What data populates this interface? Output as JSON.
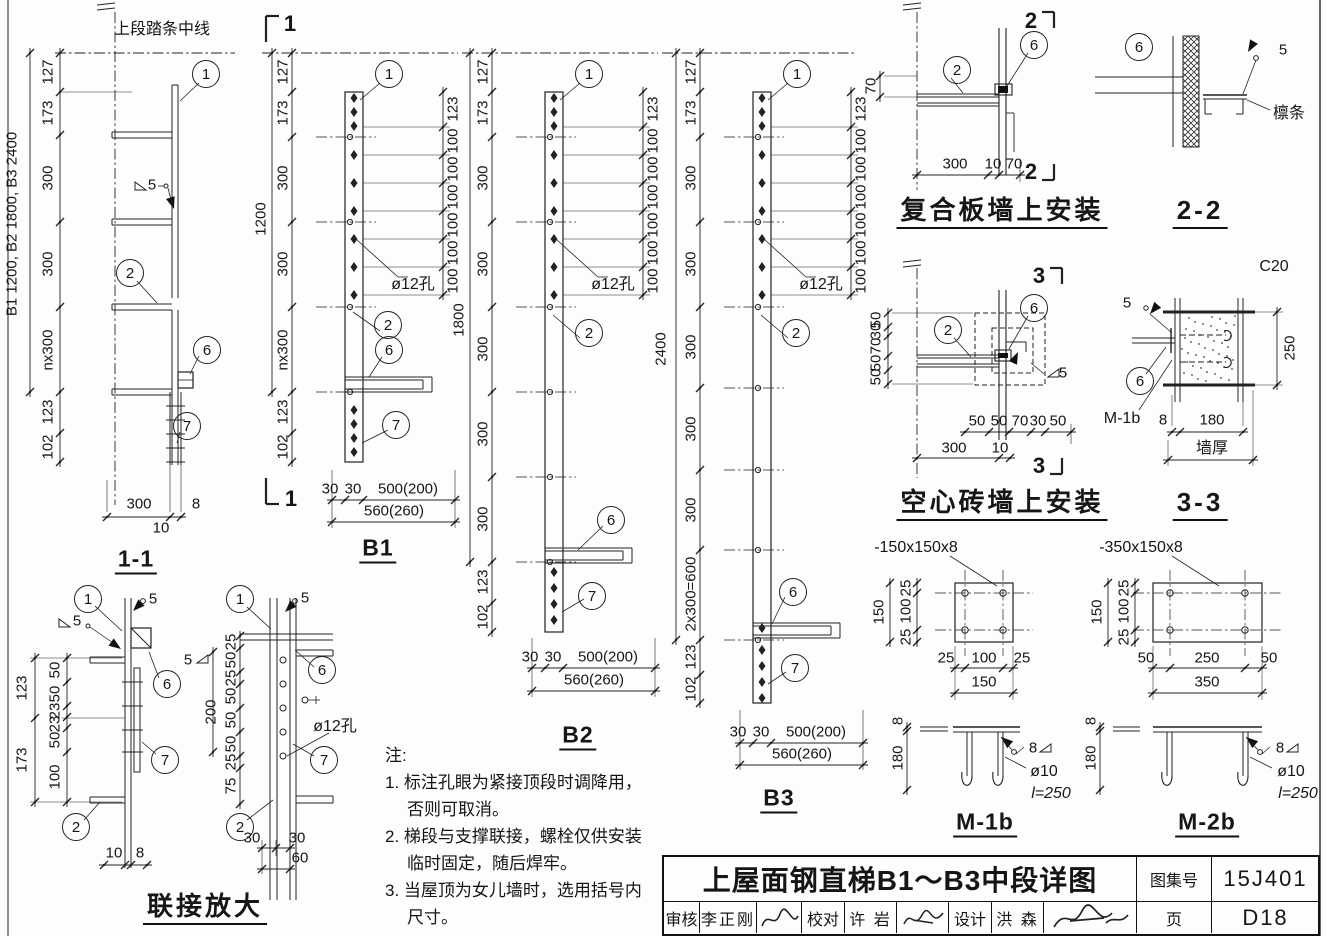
{
  "titleblock": {
    "title": "上屋面钢直梯B1～B3中段详图",
    "atlas_label": "图集号",
    "atlas_no": "15J401",
    "page_label": "页",
    "page_no": "D18",
    "audit_label": "审核",
    "audit_name": "李正刚",
    "proof_label": "校对",
    "proof_name": "许 岩",
    "design_label": "设计",
    "design_name": "洪 森"
  },
  "notes": {
    "heading": "注:",
    "items": [
      {
        "first": "1. 标注孔眼为紧接顶段时调降用，",
        "cont": "否则可取消。"
      },
      {
        "first": "2. 梯段与支撑联接，螺栓仅供安装",
        "cont": "临时固定，随后焊牢。"
      },
      {
        "first": "3. 当屋顶为女儿墙时，选用括号内",
        "cont": "尺寸。"
      }
    ]
  },
  "labels": [
    {
      "t": "上段踏条中线",
      "x": 162,
      "y": 30,
      "c": "cn"
    },
    {
      "t": "B1 1200, B2 1800, B3 2400",
      "x": 12,
      "y": 224,
      "v": 1
    },
    {
      "t": "127",
      "x": 48,
      "y": 72,
      "v": 1
    },
    {
      "t": "173",
      "x": 48,
      "y": 113,
      "v": 1
    },
    {
      "t": "300",
      "x": 48,
      "y": 178,
      "v": 1
    },
    {
      "t": "300",
      "x": 48,
      "y": 264,
      "v": 1
    },
    {
      "t": "nx300",
      "x": 48,
      "y": 350,
      "v": 1
    },
    {
      "t": "123",
      "x": 48,
      "y": 412,
      "v": 1
    },
    {
      "t": "102",
      "x": 48,
      "y": 447,
      "v": 1
    },
    {
      "t": "1",
      "x": 206,
      "y": 74,
      "c": "callout"
    },
    {
      "t": "5",
      "x": 152,
      "y": 185
    },
    {
      "t": "2",
      "x": 130,
      "y": 273,
      "c": "callout"
    },
    {
      "t": "6",
      "x": 207,
      "y": 350,
      "c": "callout"
    },
    {
      "t": "7",
      "x": 187,
      "y": 426,
      "c": "callout"
    },
    {
      "t": "300",
      "x": 139,
      "y": 504
    },
    {
      "t": "8",
      "x": 196,
      "y": 504
    },
    {
      "t": "10",
      "x": 161,
      "y": 528
    },
    {
      "t": "1-1",
      "x": 136,
      "y": 561,
      "c": "title",
      "n": "title-section-1-1"
    },
    {
      "t": "1",
      "x": 88,
      "y": 599,
      "c": "callout"
    },
    {
      "t": "5",
      "x": 153,
      "y": 599
    },
    {
      "t": "5",
      "x": 77,
      "y": 621
    },
    {
      "t": "5",
      "x": 188,
      "y": 660
    },
    {
      "t": "6",
      "x": 167,
      "y": 684,
      "c": "callout"
    },
    {
      "t": "123",
      "x": 22,
      "y": 688,
      "v": 1
    },
    {
      "t": "173",
      "x": 22,
      "y": 760,
      "v": 1
    },
    {
      "t": "50",
      "x": 55,
      "y": 670,
      "v": 1
    },
    {
      "t": "50",
      "x": 55,
      "y": 694,
      "v": 1
    },
    {
      "t": "23",
      "x": 55,
      "y": 711,
      "v": 1
    },
    {
      "t": "23",
      "x": 55,
      "y": 724,
      "v": 1
    },
    {
      "t": "50",
      "x": 55,
      "y": 740,
      "v": 1
    },
    {
      "t": "100",
      "x": 55,
      "y": 777,
      "v": 1
    },
    {
      "t": "7",
      "x": 165,
      "y": 760,
      "c": "callout"
    },
    {
      "t": "2",
      "x": 76,
      "y": 827,
      "c": "callout"
    },
    {
      "t": "10",
      "x": 114,
      "y": 853
    },
    {
      "t": "8",
      "x": 140,
      "y": 853
    },
    {
      "t": "1",
      "x": 240,
      "y": 599,
      "c": "callout"
    },
    {
      "t": "5",
      "x": 305,
      "y": 598
    },
    {
      "t": "200",
      "x": 211,
      "y": 712,
      "v": 1
    },
    {
      "t": "25",
      "x": 231,
      "y": 642,
      "v": 1
    },
    {
      "t": "50",
      "x": 231,
      "y": 660,
      "v": 1
    },
    {
      "t": "25",
      "x": 231,
      "y": 678,
      "v": 1
    },
    {
      "t": "50",
      "x": 231,
      "y": 696,
      "v": 1
    },
    {
      "t": "50",
      "x": 231,
      "y": 720,
      "v": 1
    },
    {
      "t": "50",
      "x": 231,
      "y": 744,
      "v": 1
    },
    {
      "t": "25",
      "x": 231,
      "y": 762,
      "v": 1
    },
    {
      "t": "75",
      "x": 231,
      "y": 786,
      "v": 1
    },
    {
      "t": "6",
      "x": 322,
      "y": 670,
      "c": "callout"
    },
    {
      "t": "ø12孔",
      "x": 335,
      "y": 727,
      "c": "cn"
    },
    {
      "t": "7",
      "x": 324,
      "y": 760,
      "c": "callout"
    },
    {
      "t": "2",
      "x": 240,
      "y": 827,
      "c": "callout"
    },
    {
      "t": "30",
      "x": 252,
      "y": 838
    },
    {
      "t": "30",
      "x": 297,
      "y": 838
    },
    {
      "t": "60",
      "x": 300,
      "y": 858
    },
    {
      "t": "联接放大",
      "x": 205,
      "y": 909,
      "c": "bigtitle",
      "n": "heading-lianjie-fangda"
    },
    {
      "t": "1",
      "x": 290,
      "y": 24,
      "c": "secnum"
    },
    {
      "t": "1",
      "x": 291,
      "y": 499,
      "c": "secnum"
    },
    {
      "t": "1200",
      "x": 261,
      "y": 219,
      "v": 1
    },
    {
      "t": "127",
      "x": 283,
      "y": 72,
      "v": 1
    },
    {
      "t": "173",
      "x": 283,
      "y": 113,
      "v": 1
    },
    {
      "t": "300",
      "x": 283,
      "y": 178,
      "v": 1
    },
    {
      "t": "300",
      "x": 283,
      "y": 264,
      "v": 1
    },
    {
      "t": "nx300",
      "x": 283,
      "y": 350,
      "v": 1
    },
    {
      "t": "123",
      "x": 283,
      "y": 412,
      "v": 1
    },
    {
      "t": "102",
      "x": 283,
      "y": 447,
      "v": 1
    },
    {
      "t": "1",
      "x": 389,
      "y": 74,
      "c": "callout"
    },
    {
      "t": "123",
      "x": 453,
      "y": 109,
      "v": 1
    },
    {
      "t": "100",
      "x": 453,
      "y": 141,
      "v": 1
    },
    {
      "t": "100",
      "x": 453,
      "y": 169,
      "v": 1
    },
    {
      "t": "100",
      "x": 453,
      "y": 197,
      "v": 1
    },
    {
      "t": "100",
      "x": 453,
      "y": 225,
      "v": 1
    },
    {
      "t": "100",
      "x": 453,
      "y": 253,
      "v": 1
    },
    {
      "t": "100",
      "x": 453,
      "y": 281,
      "v": 1
    },
    {
      "t": "ø12孔",
      "x": 413,
      "y": 285,
      "c": "cn"
    },
    {
      "t": "2",
      "x": 388,
      "y": 325,
      "c": "callout"
    },
    {
      "t": "6",
      "x": 389,
      "y": 350,
      "c": "callout"
    },
    {
      "t": "7",
      "x": 396,
      "y": 425,
      "c": "callout"
    },
    {
      "t": "30",
      "x": 330,
      "y": 489
    },
    {
      "t": "30",
      "x": 353,
      "y": 489
    },
    {
      "t": "500(200)",
      "x": 408,
      "y": 489
    },
    {
      "t": "560(260)",
      "x": 394,
      "y": 511
    },
    {
      "t": "B1",
      "x": 378,
      "y": 550,
      "c": "title",
      "n": "title-b1"
    },
    {
      "t": "1800",
      "x": 459,
      "y": 320,
      "v": 1
    },
    {
      "t": "127",
      "x": 483,
      "y": 72,
      "v": 1
    },
    {
      "t": "173",
      "x": 483,
      "y": 113,
      "v": 1
    },
    {
      "t": "300",
      "x": 483,
      "y": 178,
      "v": 1
    },
    {
      "t": "300",
      "x": 483,
      "y": 264,
      "v": 1
    },
    {
      "t": "300",
      "x": 483,
      "y": 349,
      "v": 1
    },
    {
      "t": "300",
      "x": 483,
      "y": 434,
      "v": 1
    },
    {
      "t": "300",
      "x": 483,
      "y": 519,
      "v": 1
    },
    {
      "t": "123",
      "x": 483,
      "y": 582,
      "v": 1
    },
    {
      "t": "102",
      "x": 483,
      "y": 617,
      "v": 1
    },
    {
      "t": "1",
      "x": 589,
      "y": 74,
      "c": "callout"
    },
    {
      "t": "123",
      "x": 653,
      "y": 109,
      "v": 1
    },
    {
      "t": "100",
      "x": 653,
      "y": 141,
      "v": 1
    },
    {
      "t": "100",
      "x": 653,
      "y": 169,
      "v": 1
    },
    {
      "t": "100",
      "x": 653,
      "y": 197,
      "v": 1
    },
    {
      "t": "100",
      "x": 653,
      "y": 225,
      "v": 1
    },
    {
      "t": "100",
      "x": 653,
      "y": 253,
      "v": 1
    },
    {
      "t": "100",
      "x": 653,
      "y": 281,
      "v": 1
    },
    {
      "t": "ø12孔",
      "x": 613,
      "y": 285,
      "c": "cn"
    },
    {
      "t": "2",
      "x": 589,
      "y": 333,
      "c": "callout"
    },
    {
      "t": "6",
      "x": 611,
      "y": 520,
      "c": "callout"
    },
    {
      "t": "7",
      "x": 592,
      "y": 596,
      "c": "callout"
    },
    {
      "t": "30",
      "x": 530,
      "y": 657
    },
    {
      "t": "30",
      "x": 553,
      "y": 657
    },
    {
      "t": "500(200)",
      "x": 608,
      "y": 657
    },
    {
      "t": "560(260)",
      "x": 594,
      "y": 680
    },
    {
      "t": "B2",
      "x": 578,
      "y": 737,
      "c": "title",
      "n": "title-b2"
    },
    {
      "t": "2400",
      "x": 661,
      "y": 349,
      "v": 1
    },
    {
      "t": "127",
      "x": 691,
      "y": 72,
      "v": 1
    },
    {
      "t": "173",
      "x": 691,
      "y": 113,
      "v": 1
    },
    {
      "t": "300",
      "x": 691,
      "y": 178,
      "v": 1
    },
    {
      "t": "300",
      "x": 691,
      "y": 264,
      "v": 1
    },
    {
      "t": "300",
      "x": 691,
      "y": 347,
      "v": 1
    },
    {
      "t": "300",
      "x": 691,
      "y": 429,
      "v": 1
    },
    {
      "t": "300",
      "x": 691,
      "y": 510,
      "v": 1
    },
    {
      "t": "2x300=600",
      "x": 691,
      "y": 594,
      "v": 1
    },
    {
      "t": "123",
      "x": 691,
      "y": 657,
      "v": 1
    },
    {
      "t": "102",
      "x": 691,
      "y": 689,
      "v": 1
    },
    {
      "t": "1",
      "x": 797,
      "y": 74,
      "c": "callout"
    },
    {
      "t": "123",
      "x": 861,
      "y": 109,
      "v": 1
    },
    {
      "t": "100",
      "x": 861,
      "y": 141,
      "v": 1
    },
    {
      "t": "100",
      "x": 861,
      "y": 169,
      "v": 1
    },
    {
      "t": "100",
      "x": 861,
      "y": 197,
      "v": 1
    },
    {
      "t": "100",
      "x": 861,
      "y": 225,
      "v": 1
    },
    {
      "t": "100",
      "x": 861,
      "y": 253,
      "v": 1
    },
    {
      "t": "100",
      "x": 861,
      "y": 281,
      "v": 1
    },
    {
      "t": "ø12孔",
      "x": 821,
      "y": 285,
      "c": "cn"
    },
    {
      "t": "2",
      "x": 796,
      "y": 333,
      "c": "callout"
    },
    {
      "t": "6",
      "x": 793,
      "y": 592,
      "c": "callout"
    },
    {
      "t": "7",
      "x": 795,
      "y": 668,
      "c": "callout"
    },
    {
      "t": "30",
      "x": 738,
      "y": 732
    },
    {
      "t": "30",
      "x": 761,
      "y": 732
    },
    {
      "t": "500(200)",
      "x": 816,
      "y": 732
    },
    {
      "t": "560(260)",
      "x": 802,
      "y": 754
    },
    {
      "t": "B3",
      "x": 779,
      "y": 800,
      "c": "title",
      "n": "title-b3"
    },
    {
      "t": "2",
      "x": 957,
      "y": 70,
      "c": "callout"
    },
    {
      "t": "6",
      "x": 1034,
      "y": 45,
      "c": "callout"
    },
    {
      "t": "2",
      "x": 1031,
      "y": 21,
      "c": "secnum"
    },
    {
      "t": "2",
      "x": 1031,
      "y": 172,
      "c": "secnum"
    },
    {
      "t": "70",
      "x": 871,
      "y": 86,
      "v": 1
    },
    {
      "t": "300",
      "x": 955,
      "y": 164
    },
    {
      "t": "10",
      "x": 993,
      "y": 164
    },
    {
      "t": "70",
      "x": 1014,
      "y": 164
    },
    {
      "t": "复合板墙上安装",
      "x": 1002,
      "y": 213,
      "c": "bigtitle",
      "n": "heading-fuheban"
    },
    {
      "t": "2-2",
      "x": 1200,
      "y": 213,
      "c": "bigtitle",
      "n": "heading-2-2"
    },
    {
      "t": "6",
      "x": 1139,
      "y": 47,
      "c": "callout"
    },
    {
      "t": "5",
      "x": 1283,
      "y": 50
    },
    {
      "t": "檩条",
      "x": 1289,
      "y": 114,
      "c": "cn"
    },
    {
      "t": "2",
      "x": 948,
      "y": 330,
      "c": "callout"
    },
    {
      "t": "6",
      "x": 1034,
      "y": 308,
      "c": "callout"
    },
    {
      "t": "3",
      "x": 1039,
      "y": 276,
      "c": "secnum"
    },
    {
      "t": "3",
      "x": 1039,
      "y": 466,
      "c": "secnum"
    },
    {
      "t": "5",
      "x": 1063,
      "y": 373
    },
    {
      "t": "50",
      "x": 876,
      "y": 320,
      "v": 1
    },
    {
      "t": "30",
      "x": 876,
      "y": 331,
      "v": 1
    },
    {
      "t": "70",
      "x": 876,
      "y": 346,
      "v": 1
    },
    {
      "t": "50",
      "x": 876,
      "y": 363,
      "v": 1
    },
    {
      "t": "50",
      "x": 876,
      "y": 377,
      "v": 1
    },
    {
      "t": "50",
      "x": 977,
      "y": 421
    },
    {
      "t": "50",
      "x": 999,
      "y": 421
    },
    {
      "t": "70",
      "x": 1020,
      "y": 421
    },
    {
      "t": "30",
      "x": 1038,
      "y": 421
    },
    {
      "t": "50",
      "x": 1058,
      "y": 421
    },
    {
      "t": "300",
      "x": 954,
      "y": 448
    },
    {
      "t": "10",
      "x": 1000,
      "y": 448
    },
    {
      "t": "空心砖墙上安装",
      "x": 1002,
      "y": 505,
      "c": "bigtitle",
      "n": "heading-kongxin"
    },
    {
      "t": "3-3",
      "x": 1200,
      "y": 505,
      "c": "bigtitle",
      "n": "heading-3-3"
    },
    {
      "t": "C20",
      "x": 1274,
      "y": 267,
      "c": "dim16"
    },
    {
      "t": "5",
      "x": 1127,
      "y": 303
    },
    {
      "t": "6",
      "x": 1140,
      "y": 381,
      "c": "callout"
    },
    {
      "t": "M-1b",
      "x": 1122,
      "y": 419,
      "c": "dim16"
    },
    {
      "t": "250",
      "x": 1290,
      "y": 348,
      "v": 1
    },
    {
      "t": "8",
      "x": 1163,
      "y": 420
    },
    {
      "t": "180",
      "x": 1212,
      "y": 420
    },
    {
      "t": "墙厚",
      "x": 1212,
      "y": 449,
      "c": "cn"
    },
    {
      "t": "-150x150x8",
      "x": 916,
      "y": 548,
      "c": "dim16"
    },
    {
      "t": "150",
      "x": 879,
      "y": 612,
      "v": 1
    },
    {
      "t": "25",
      "x": 906,
      "y": 588,
      "v": 1
    },
    {
      "t": "100",
      "x": 906,
      "y": 611,
      "v": 1
    },
    {
      "t": "25",
      "x": 906,
      "y": 637,
      "v": 1
    },
    {
      "t": "25",
      "x": 946,
      "y": 658
    },
    {
      "t": "100",
      "x": 984,
      "y": 658
    },
    {
      "t": "25",
      "x": 1022,
      "y": 658
    },
    {
      "t": "150",
      "x": 984,
      "y": 682
    },
    {
      "t": "8",
      "x": 898,
      "y": 721,
      "v": 1
    },
    {
      "t": "180",
      "x": 898,
      "y": 758,
      "v": 1
    },
    {
      "t": "8",
      "x": 1033,
      "y": 748
    },
    {
      "t": "ø10",
      "x": 1044,
      "y": 772,
      "c": "dim16"
    },
    {
      "t": "l=250",
      "x": 1051,
      "y": 794,
      "c": "dim16i"
    },
    {
      "t": "M-1b",
      "x": 985,
      "y": 824,
      "c": "title",
      "n": "title-m1b"
    },
    {
      "t": "-350x150x8",
      "x": 1141,
      "y": 548,
      "c": "dim16"
    },
    {
      "t": "150",
      "x": 1097,
      "y": 612,
      "v": 1
    },
    {
      "t": "25",
      "x": 1124,
      "y": 588,
      "v": 1
    },
    {
      "t": "100",
      "x": 1124,
      "y": 611,
      "v": 1
    },
    {
      "t": "25",
      "x": 1124,
      "y": 637,
      "v": 1
    },
    {
      "t": "50",
      "x": 1146,
      "y": 658
    },
    {
      "t": "250",
      "x": 1207,
      "y": 658
    },
    {
      "t": "50",
      "x": 1269,
      "y": 658
    },
    {
      "t": "350",
      "x": 1207,
      "y": 682
    },
    {
      "t": "8",
      "x": 1091,
      "y": 721,
      "v": 1
    },
    {
      "t": "180",
      "x": 1091,
      "y": 758,
      "v": 1
    },
    {
      "t": "8",
      "x": 1280,
      "y": 748
    },
    {
      "t": "ø10",
      "x": 1291,
      "y": 772,
      "c": "dim16"
    },
    {
      "t": "l=250",
      "x": 1298,
      "y": 794,
      "c": "dim16i"
    },
    {
      "t": "M-2b",
      "x": 1207,
      "y": 824,
      "c": "title",
      "n": "title-m2b"
    }
  ]
}
